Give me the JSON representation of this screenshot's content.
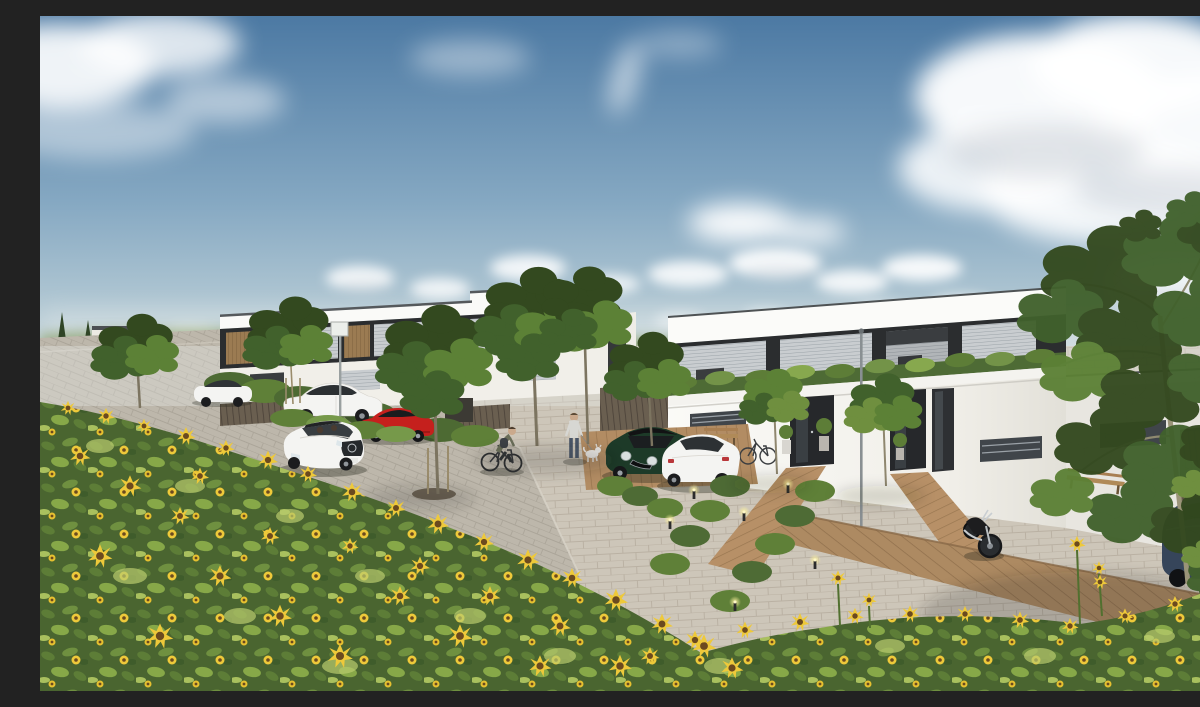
{
  "meta": {
    "title": "Sunny 3D architectural rendering of a modern flat-roof residential street with a sunflower field in the foreground",
    "scene_type": "exterior architectural visualization",
    "time_of_day": "daytime",
    "weather": "partly cloudy blue sky"
  },
  "palette": {
    "sky_top": "#4c79a3",
    "sky_horizon": "#dfe5e2",
    "cloud_white": "#ffffff",
    "cloud_shadow": "#c3c9d2",
    "meadow": "#b8c255",
    "facade_white": "#f7f6f2",
    "facade_shade": "#e8e6e0",
    "upper_dark": "#2b2d2f",
    "wood_slat": "#9b7b52",
    "window_blind": "#c9cdd0",
    "hedge_green": "#4e6b35",
    "tree_dark": "#33491f",
    "tree_mid": "#41612c",
    "tree_light": "#5c8136",
    "paver_court": "#cdc6b9",
    "street_grey": "#bdb7ab",
    "deck_wood": "#b28c63",
    "fence_wood": "#6a5f50",
    "car_white": "#f4f4f2",
    "car_red": "#c5201d",
    "car_green": "#1d3a28",
    "car_blue": "#36455a",
    "moto_black": "#1d1d1f",
    "sunflower_yellow": "#eec93a",
    "sunflower_center": "#6b4a1f",
    "field_green": "#4a6530"
  },
  "scene": {
    "sky": {
      "label": "blue sky with scattered cumulus clouds"
    },
    "background": {
      "left": "distant white houses, conifers and a red container beside a grey street",
      "right": "yellow-green meadow with hedgerow behind a timber fence"
    },
    "buildings": {
      "left_row": {
        "label": "receding row of two-storey flat-roof terraced houses, white render, dark window band with wood slat panels"
      },
      "main_duplex": {
        "label": "two-storey white duplex, anthracite upper window band with roller blinds, roof-edge planting, two recessed dark entrances, single-storey wing to the right"
      }
    },
    "street": {
      "label": "grey paver street curving from lower centre to the upper left"
    },
    "court": {
      "label": "light paver forecourt with timber deck walkways and parking pads"
    },
    "vehicles": [
      {
        "name": "parked-white-coupe",
        "color_ref": "car_white"
      },
      {
        "name": "red-sports-car",
        "color_ref": "car_red"
      },
      {
        "name": "driving-white-sedan",
        "color_ref": "car_white"
      },
      {
        "name": "distant-white-car",
        "color_ref": "car_white"
      },
      {
        "name": "green-mini",
        "color_ref": "car_green"
      },
      {
        "name": "white-golf",
        "color_ref": "car_white"
      },
      {
        "name": "blue-car",
        "color_ref": "car_blue"
      },
      {
        "name": "black-motorcycle",
        "color_ref": "moto_black"
      }
    ],
    "people": [
      {
        "name": "cyclist",
        "label": "person riding a bicycle"
      },
      {
        "name": "pedestrian",
        "label": "person walking a small white dog"
      }
    ],
    "vegetation": {
      "sunflower_field": "dense sunflower field filling the foreground",
      "street_trees": "young staked street trees",
      "large_tree": "large leafy tree overhanging from the right edge"
    },
    "furniture": [
      "wooden bench",
      "bicycle at entrance",
      "bollard lights",
      "street lamp",
      "street sign",
      "timber fence"
    ]
  }
}
